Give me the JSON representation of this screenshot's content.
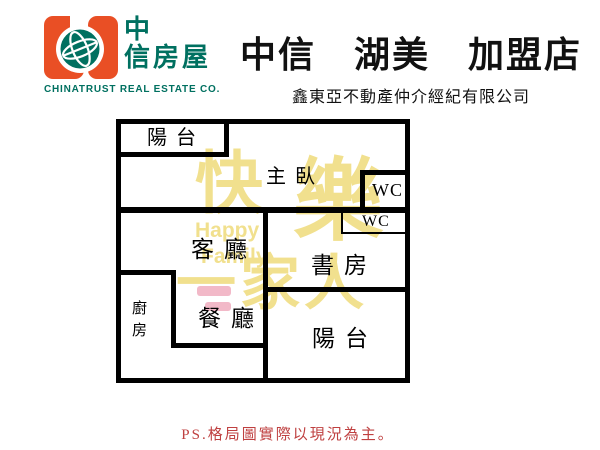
{
  "brand": {
    "logo_cjk_line1": "中",
    "logo_cjk_line2": "信房屋",
    "logo_en": "CHINATRUST REAL ESTATE CO.",
    "orange": "#e94f25",
    "teal": "#007060"
  },
  "header": {
    "title": "中信　湖美　加盟店",
    "subtitle": "鑫東亞不動產仲介經紀有限公司"
  },
  "floorplan": {
    "labels": {
      "balcony_top": "陽台",
      "master_bedroom": "主臥",
      "wc_top": "WC",
      "wc_mid": "WC",
      "living_room": "客廳",
      "study": "書房",
      "dining_room": "餐廳",
      "kitchen": "廚房",
      "balcony_bottom": "陽台"
    },
    "watermark": {
      "char1": "快",
      "char2": "樂",
      "en_word1": "Happy",
      "en_word2": "Family",
      "line2": "一家人",
      "yellow": "#f1e08e",
      "pink": "#f2b9c8"
    }
  },
  "footer": {
    "note": "PS.格局圖實際以現況為主。",
    "red": "#bf4040"
  }
}
